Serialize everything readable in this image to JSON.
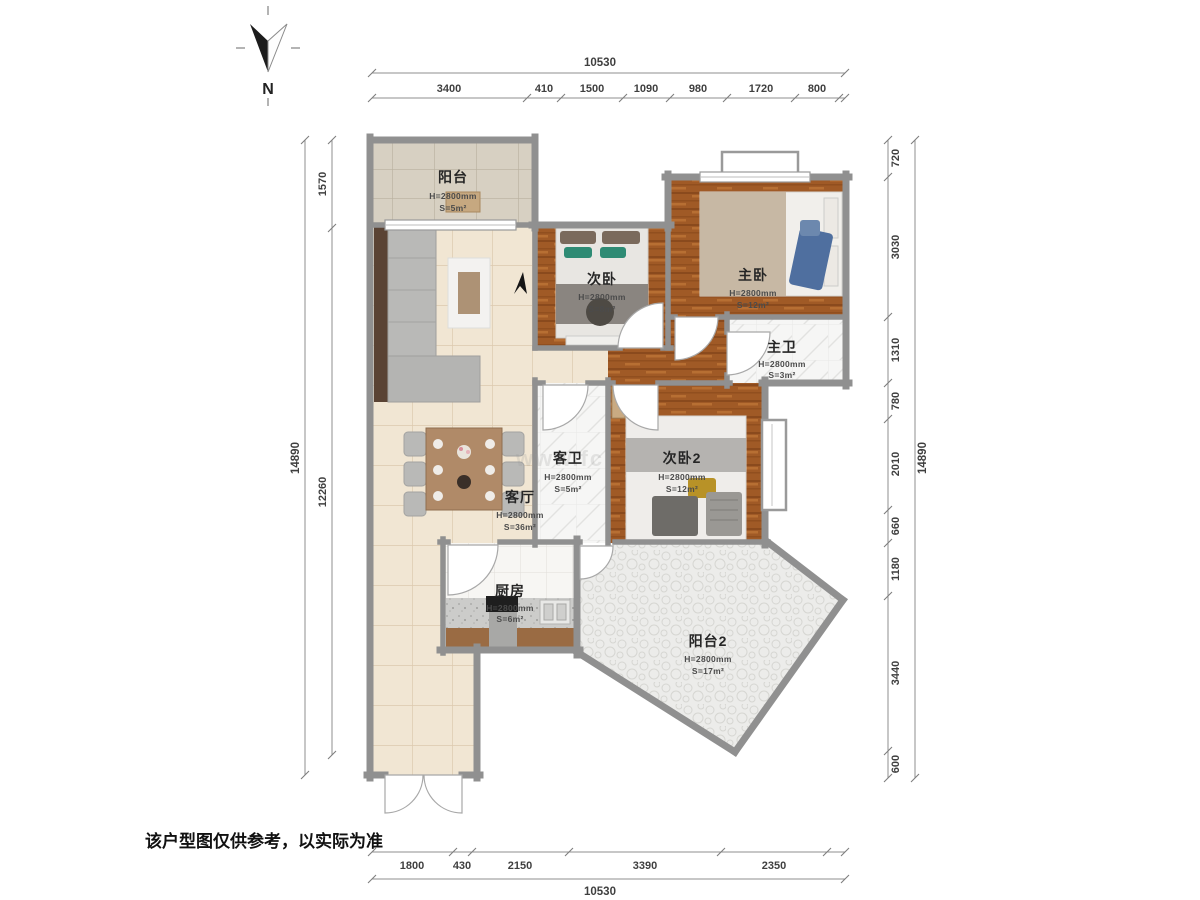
{
  "meta": {
    "note": "该户型图仅供参考，以实际为准",
    "compass_label": "N",
    "watermark": "www.fc"
  },
  "colors": {
    "wall": "#909090",
    "wood_floor": "#a05a26",
    "tile_floor": "#f1e6d3",
    "balcony_tile": "#d7d0c2",
    "stone_floor": "#ececea",
    "accent_teal": "#2e8b74",
    "accent_blue": "#4f6f9f"
  },
  "rooms": [
    {
      "name": "阳台",
      "height": "H=2800mm",
      "area": "S=5m²"
    },
    {
      "name": "次卧",
      "height": "H=2800mm",
      "area": "S=8m²"
    },
    {
      "name": "主卧",
      "height": "H=2800mm",
      "area": "S=12m²"
    },
    {
      "name": "主卫",
      "height": "H=2800mm",
      "area": "S=3m²"
    },
    {
      "name": "客卫",
      "height": "H=2800mm",
      "area": "S=5m²"
    },
    {
      "name": "次卧2",
      "height": "H=2800mm",
      "area": "S=12m²"
    },
    {
      "name": "客厅",
      "height": "H=2800mm",
      "area": "S=36m²"
    },
    {
      "name": "厨房",
      "height": "H=2800mm",
      "area": "S=6m²"
    },
    {
      "name": "阳台2",
      "height": "H=2800mm",
      "area": "S=17m²"
    }
  ],
  "dimensions": {
    "top": {
      "total": "10530",
      "segments": [
        "3400",
        "410",
        "1500",
        "1090",
        "980",
        "1720",
        "800"
      ]
    },
    "bottom": {
      "total": "10530",
      "segments": [
        "1800",
        "430",
        "2150",
        "3390",
        "2350"
      ]
    },
    "left": {
      "total": "14890",
      "segments": [
        "1570",
        "12260"
      ]
    },
    "right": {
      "total": "14890",
      "segments": [
        "720",
        "3030",
        "1310",
        "780",
        "2010",
        "660",
        "1180",
        "3440",
        "600"
      ]
    }
  }
}
